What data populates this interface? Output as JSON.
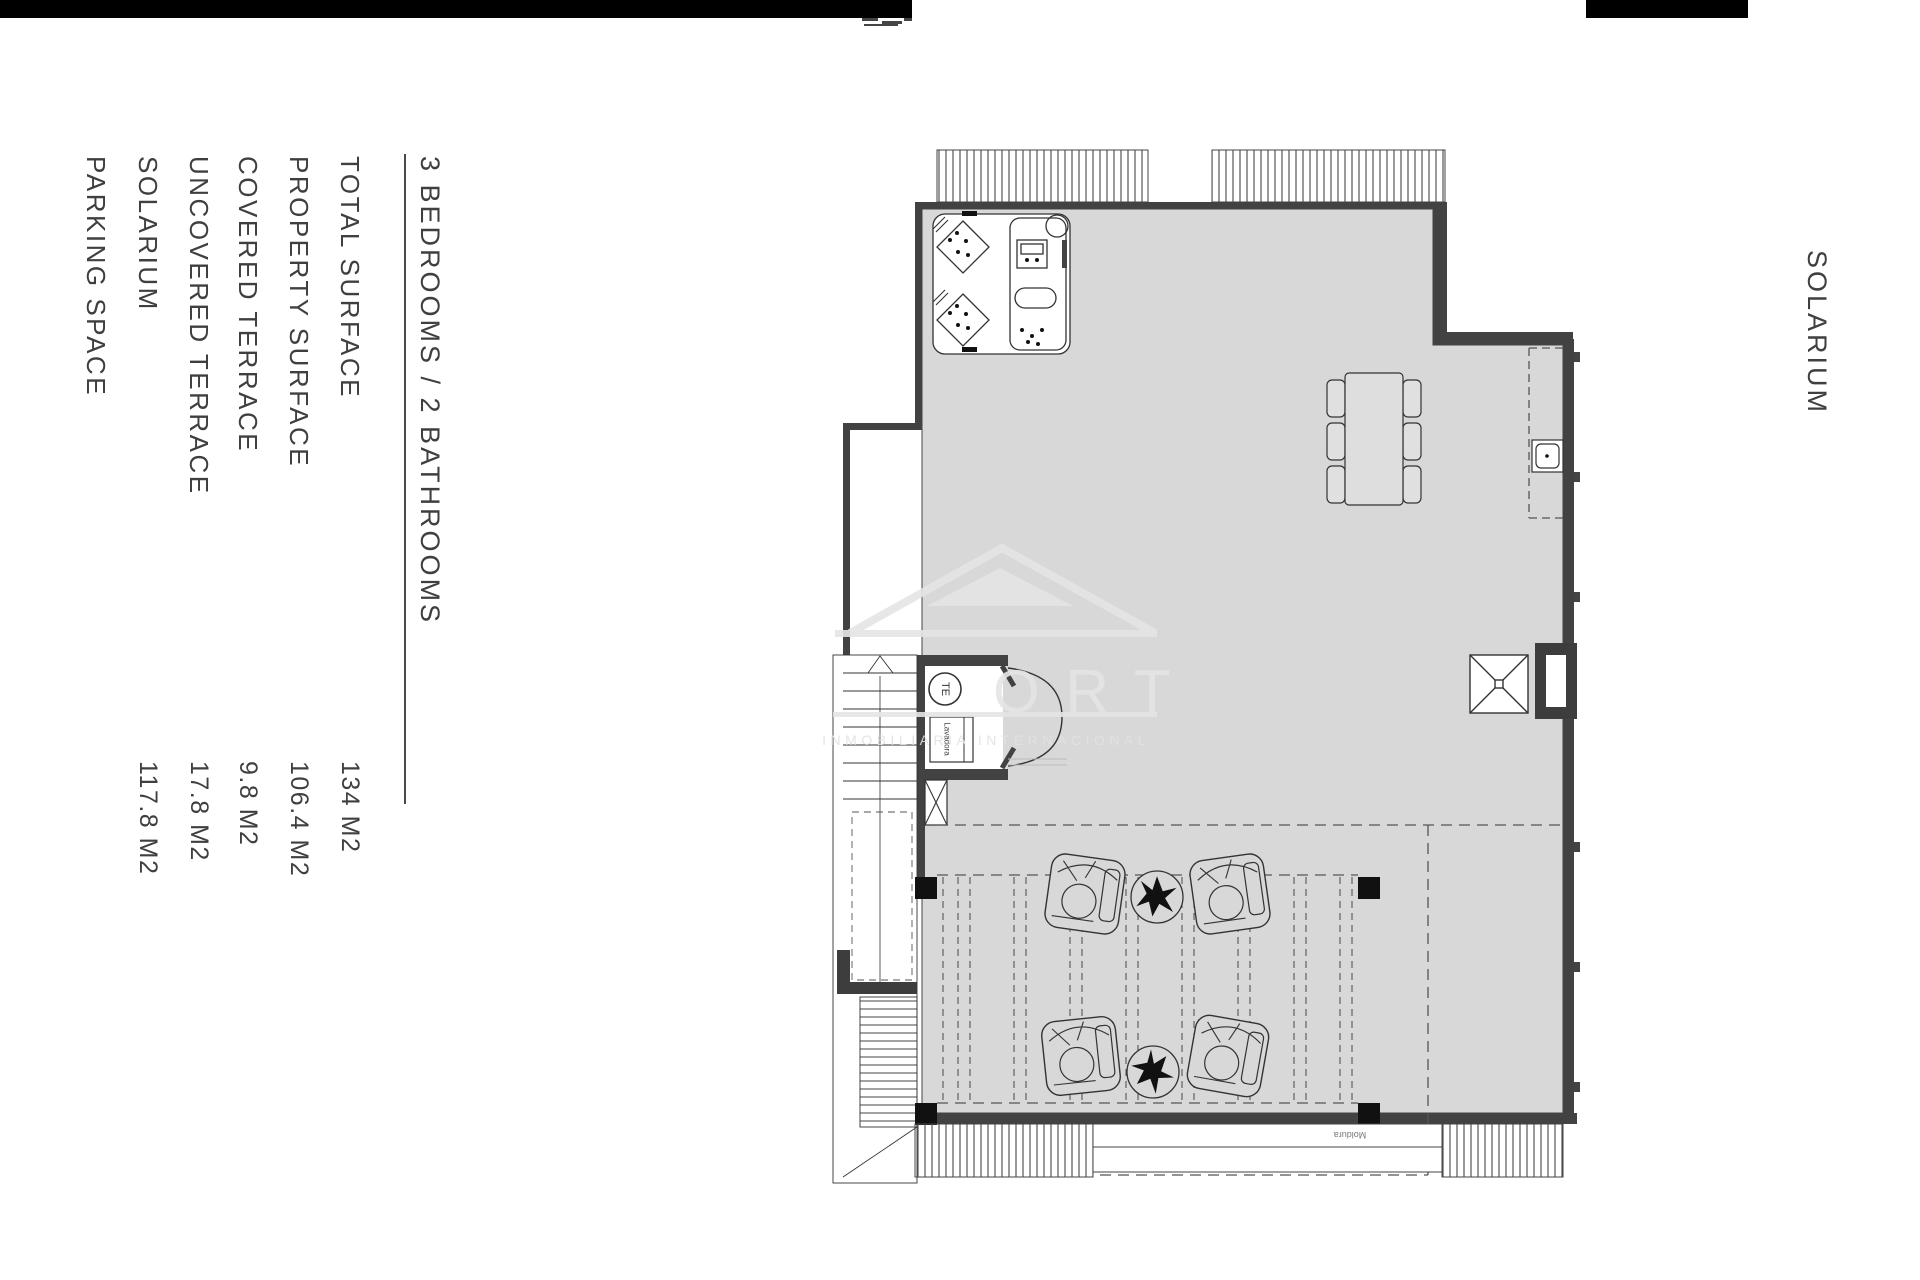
{
  "document_type": "real-estate floor plan sheet",
  "floor_name": "SOLARIUM",
  "specs": {
    "heading": "3 BEDROOMS / 2 BATHROOMS",
    "rows": [
      {
        "label": "TOTAL SURFACE",
        "value": "134 M2"
      },
      {
        "label": "PROPERTY SURFACE",
        "value": "106.4 M2"
      },
      {
        "label": "COVERED TERRACE",
        "value": "9.8 M2"
      },
      {
        "label": "UNCOVERED TERRACE",
        "value": "17.8 M2"
      },
      {
        "label": "SOLARIUM",
        "value": "117.8 M2"
      },
      {
        "label": "PARKING SPACE",
        "value": ""
      }
    ]
  },
  "plan_labels": {
    "water_heater": "TE",
    "washing_machine": "Lavadora",
    "molding_strip": "Moldura"
  },
  "watermark": {
    "brand_visible_letters": "ORT",
    "tagline": "INMOBILIARIA INTERNACIONAL"
  },
  "colors": {
    "page_bg": "#ffffff",
    "floor_fill": "#d8d8d8",
    "wall_dark": "#424242",
    "line": "#333333",
    "black_bar": "#000000",
    "text": "#3f3f3f",
    "watermark": "#e5e5e5",
    "dashed": "#555555"
  }
}
